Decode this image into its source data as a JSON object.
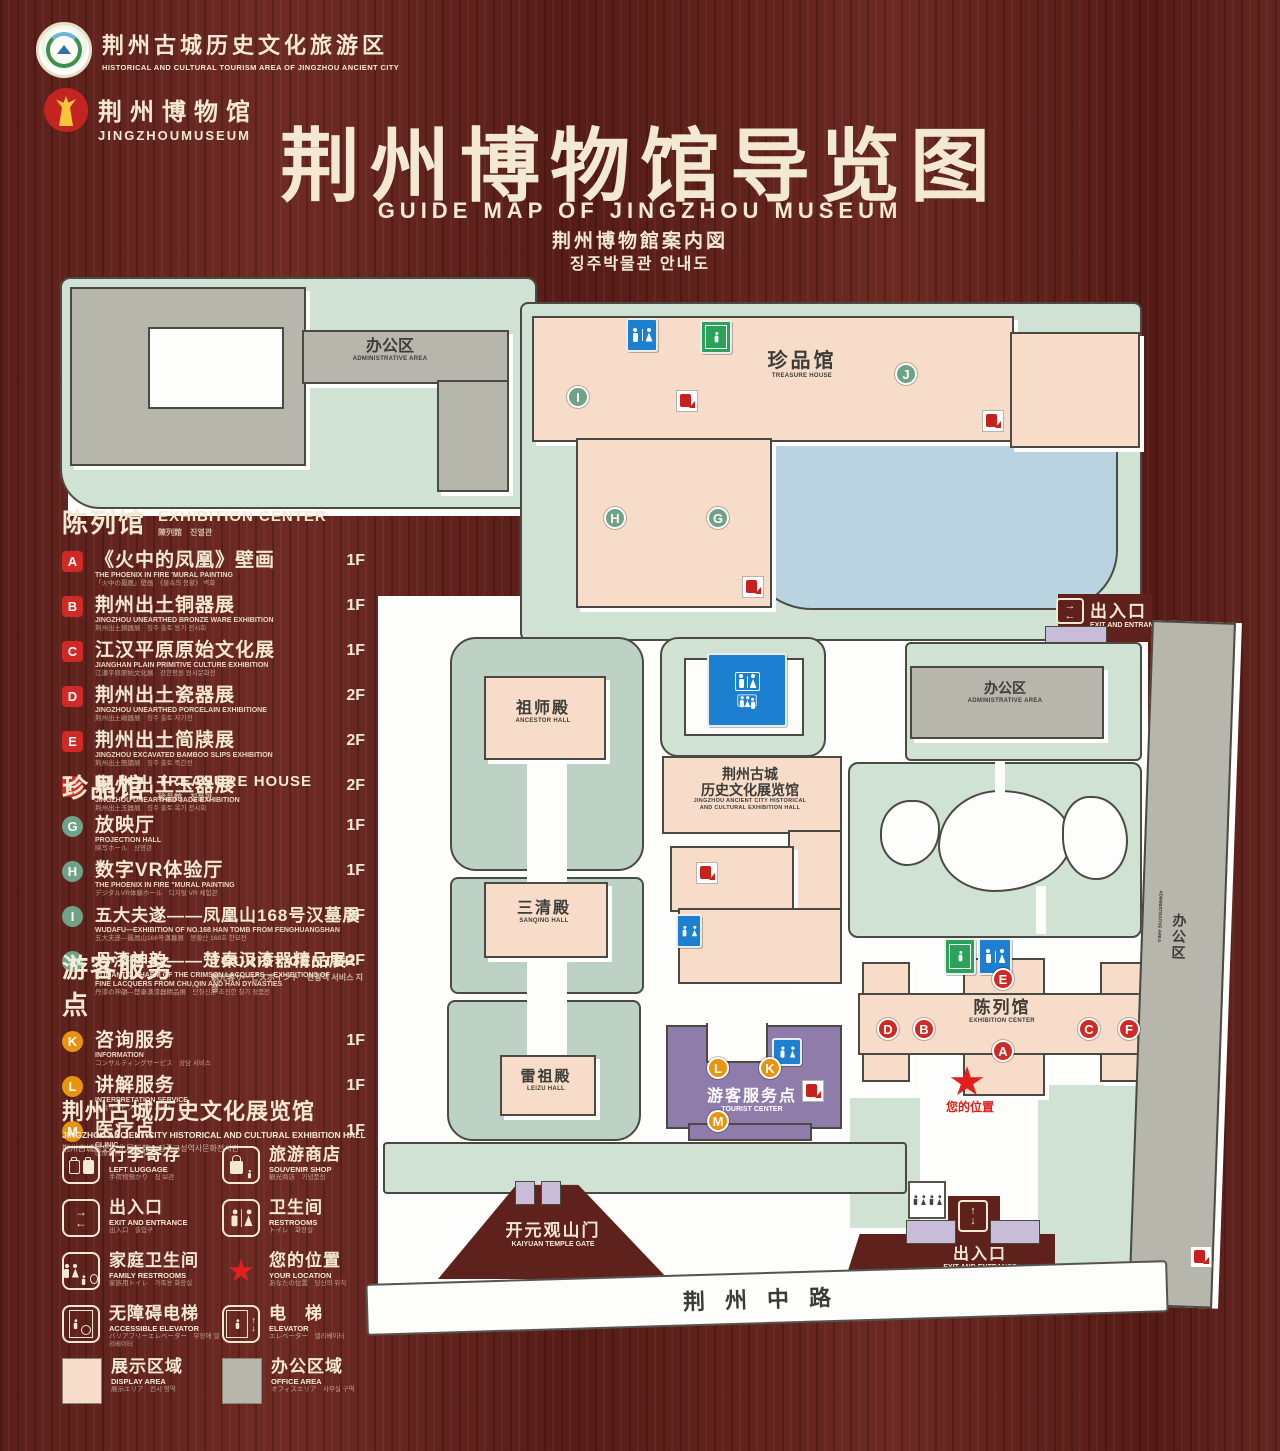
{
  "header": {
    "logo1": {
      "title": "荆州古城历史文化旅游区",
      "subtitle": "HISTORICAL AND CULTURAL TOURISM AREA OF JINGZHOU ANCIENT CITY"
    },
    "logo2": {
      "title": "荆州博物馆",
      "subtitle": "JINGZHOUMUSEUM"
    },
    "title": "荆州博物馆导览图",
    "subtitle_en": "GUIDE MAP OF JINGZHOU MUSEUM",
    "subtitle_ja": "荆州博物館案内図",
    "subtitle_ko": "징주박물관 안내도"
  },
  "legend": {
    "exhibition": {
      "cn": "陈列馆",
      "en": "EXHIBITION CENTER",
      "sub": "陳列館　진열관",
      "items": [
        {
          "letter": "A",
          "cn": "《火中的凤凰》壁画",
          "en": "THE PHOENIX IN FIRE 'MURAL PAINTING",
          "sub": "「火中の鳳凰」壁画　《불속의 봉황》 벽화",
          "floor": "1F"
        },
        {
          "letter": "B",
          "cn": "荆州出土铜器展",
          "en": "JINGZHOU UNEARTHED BRONZE WARE EXHIBITION",
          "sub": "荆州出土銅器展　징주 출토 동기 전시회",
          "floor": "1F"
        },
        {
          "letter": "C",
          "cn": "江汉平原原始文化展",
          "en": "JIANGHAN PLAIN PRIMITIVE CULTURE EXHIBITION",
          "sub": "江漢平原原始文化展　강한평원 원시문화전",
          "floor": "1F"
        },
        {
          "letter": "D",
          "cn": "荆州出土瓷器展",
          "en": "JINGZHOU UNEARTHED PORCELAIN EXHIBITIONE",
          "sub": "荆州出土磁器展　징주 출토 자기전",
          "floor": "2F"
        },
        {
          "letter": "E",
          "cn": "荆州出土简牍展",
          "en": "JINGZHOU EXCAVATED BAMBOO SLIPS EXHIBITION",
          "sub": "荆州出土簡牘展　징주 출토 죽간전",
          "floor": "2F"
        },
        {
          "letter": "F",
          "cn": "荆州出土玉器展",
          "en": "JINGZHOU UNEARTHED JADE EXHIBITION",
          "sub": "荆州出土玉器展　징주 출토 옥기 전시회",
          "floor": "2F"
        }
      ]
    },
    "treasure": {
      "cn": "珍品馆",
      "en": "TREASURE HOUSE",
      "sub": "珍品館　진품관",
      "items": [
        {
          "letter": "G",
          "cn": "放映厅",
          "en": "PROJECTION HALL",
          "sub": "映写ホール　상영관",
          "floor": "1F"
        },
        {
          "letter": "H",
          "cn": "数字VR体验厅",
          "en": "THE PHOENIX IN FIRE \"MURAL PAINTING",
          "sub": "デジタルVR体験ホール　디지털 VR 체험관",
          "floor": "1F"
        },
        {
          "letter": "I",
          "cn": "五大夫遂——凤凰山168号汉墓展",
          "en": "WUDAFU—EXHIBITION OF NO.168 HAN TOMB FROM FENGHUANGSHAN",
          "sub": "五大夫遂—鳳凰山168号漢墓展　봉황산 168호 한묘전",
          "floor": "2F"
        },
        {
          "letter": "J",
          "cn": "丹漆神韵——楚秦汉漆器精品展",
          "en": "ROMANTIC CHARM OF THE CRIMSON LACQUERS— EXHIBITIONS OF FINE LACQUERS FROM CHU,QIN AND HAN DYNASTIES",
          "sub": "丹漆の神韻—楚秦漢漆器精品展　단칠신운·초진한 칠기 정품전",
          "floor": "1-2F"
        }
      ]
    },
    "tourist": {
      "cn": "游客服务点",
      "en": "TOURIST CENTER",
      "sub": "観光客サービスポイント　관광객 서비스 지점",
      "items": [
        {
          "letter": "K",
          "cn": "咨询服务",
          "en": "INFORMATION",
          "sub": "コンサルティングサービス　상담 서비스",
          "floor": "1F"
        },
        {
          "letter": "L",
          "cn": "讲解服务",
          "en": "INTERPRETATION SERVICE",
          "sub": "解説サービス　설명 서비스",
          "floor": "1F"
        },
        {
          "letter": "M",
          "cn": "医疗点",
          "en": "CLINIC",
          "sub": "医療拠点　의료점",
          "floor": "1F"
        }
      ]
    },
    "hall_note": {
      "cn": "荆州古城历史文化展览馆",
      "en": "JINGZHOU ANCIENT CITY HISTORICAL AND CULTURAL EXHIBITION HALL",
      "sub": "荆州古城歴史文化展示館　징주고성역사문화전시관"
    },
    "facilities": [
      {
        "icon": "left-luggage",
        "cn": "行李寄存",
        "en": "LEFT LUGGAGE",
        "sub": "手荷物預かり　짐 보관"
      },
      {
        "icon": "souvenir-shop",
        "cn": "旅游商店",
        "en": "SOUVENIR SHOP",
        "sub": "観光商店　기념품점"
      },
      {
        "icon": "exit-entrance",
        "cn": "出入口",
        "en": "EXIT AND ENTRANCE",
        "sub": "出入口　출입구"
      },
      {
        "icon": "restrooms",
        "cn": "卫生间",
        "en": "RESTROOMS",
        "sub": "トイレ　화장실"
      },
      {
        "icon": "family-restrooms",
        "cn": "家庭卫生间",
        "en": "FAMILY RESTROOMS",
        "sub": "家族用トイレ　가족용 화장실"
      },
      {
        "icon": "your-location",
        "cn": "您的位置",
        "en": "YOUR LOCATION",
        "sub": "あなたの位置　당신의 위치"
      },
      {
        "icon": "accessible-elevator",
        "cn": "无障碍电梯",
        "en": "ACCESSIBLE ELEVATOR",
        "sub": "バリアフリーエレベーター　무장애 엘리베이터"
      },
      {
        "icon": "elevator",
        "cn": "电　梯",
        "en": "ELEVATOR",
        "sub": "エレベーター　엘리베이터"
      }
    ],
    "areas": [
      {
        "swatch": "#f7dcca",
        "cn": "展示区域",
        "en": "DISPLAY AREA",
        "sub": "展示エリア　전시 영역"
      },
      {
        "swatch": "#b6b6ac",
        "cn": "办公区域",
        "en": "OFFICE AREA",
        "sub": "オフィスエリア　사무실 구역"
      }
    ]
  },
  "map": {
    "admin_area_nw": {
      "cn": "办公区",
      "en": "ADMINISTRATIVE AREA"
    },
    "treasure_house": {
      "cn": "珍品馆",
      "en": "TREASURE HOUSE"
    },
    "exit_ne": {
      "cn": "出入口",
      "en": "EXIT AND ENTRANCE"
    },
    "admin_area_e": {
      "cn": "办公区",
      "en": "ADMINISTRATIVE AREA"
    },
    "admin_area_strip": {
      "cn": "办公区",
      "en": "ADMINISTRATIVE AREA"
    },
    "ancestor_hall": {
      "cn": "祖师殿",
      "en": "ANCESTOR HALL"
    },
    "sanqing_hall": {
      "cn": "三清殿",
      "en": "SANQING HALL"
    },
    "leizu_hall": {
      "cn": "雷祖殿",
      "en": "LEIZU HALL"
    },
    "exhibition_hall": {
      "cn1": "荆州古城",
      "cn2": "历史文化展览馆",
      "en1": "JINGZHOU ANCIENT CITY HISTORICAL",
      "en2": "AND CULTURAL EXHIBITION HALL"
    },
    "exhibition_center": {
      "cn": "陈列馆",
      "en": "EXHIBITION CENTER"
    },
    "tourist_center": {
      "cn": "游客服务点",
      "en": "TOURIST CENTER"
    },
    "your_location": {
      "cn": "您的位置"
    },
    "kaiyuan_gate": {
      "cn": "开元观山门",
      "en": "KAIYUAN TEMPLE GATE"
    },
    "exit_s": {
      "cn": "出入口",
      "en": "EXIT AND ENTRANCE"
    },
    "road": {
      "cn": "荆州中路"
    },
    "markers": {
      "A": "A",
      "B": "B",
      "C": "C",
      "D": "D",
      "E": "E",
      "F": "F",
      "G": "G",
      "H": "H",
      "I": "I",
      "J": "J",
      "K": "K",
      "L": "L",
      "M": "M"
    }
  },
  "colors": {
    "wood": "#5e211c",
    "cream": "#f3e9d2",
    "display_area": "#f7dcca",
    "office_area": "#b6b6ac",
    "mint": "#cfe2d3",
    "pond": "#b9d3e1",
    "tourist_purple": "#8f7cab",
    "marker_red": "#cf2a26",
    "marker_green": "#6fa287",
    "marker_orange": "#e9940f",
    "wc_blue": "#1d7fd0",
    "elevator_green": "#2aa257",
    "fire_red": "#c8201d",
    "location_red": "#e01f1f"
  }
}
